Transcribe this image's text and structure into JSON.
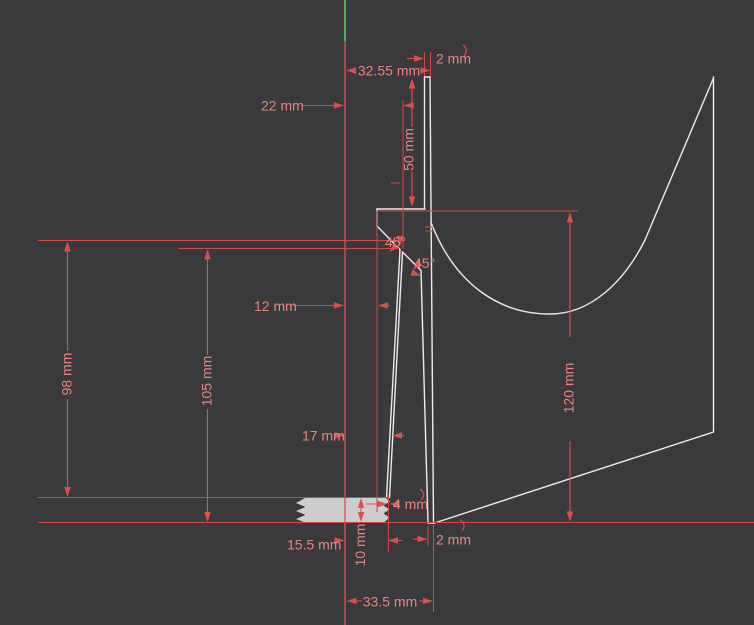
{
  "canvas": {
    "background": "#3a3a3c"
  },
  "colors": {
    "dimension_line": "#dd4f4f",
    "dimension_text": "#e88585",
    "geometry": "#ebebeb",
    "axis_green": "#4db54d",
    "section_fill": "#cdcdcd"
  },
  "dims": {
    "top_wall": "2 mm",
    "top_radius": "32.55 mm",
    "offset_22": "22 mm",
    "neck_height": "50 mm",
    "angle_outer": "45°",
    "angle_inner": "45°",
    "offset_12": "12 mm",
    "offset_17": "17 mm",
    "height_98": "98 mm",
    "height_105": "105 mm",
    "height_120": "120 mm",
    "offset_155": "15.5 mm",
    "base_height": "10 mm",
    "gap_4": "4 mm",
    "bottom_wall": "2 mm",
    "bottom_radius": "33.5 mm"
  }
}
